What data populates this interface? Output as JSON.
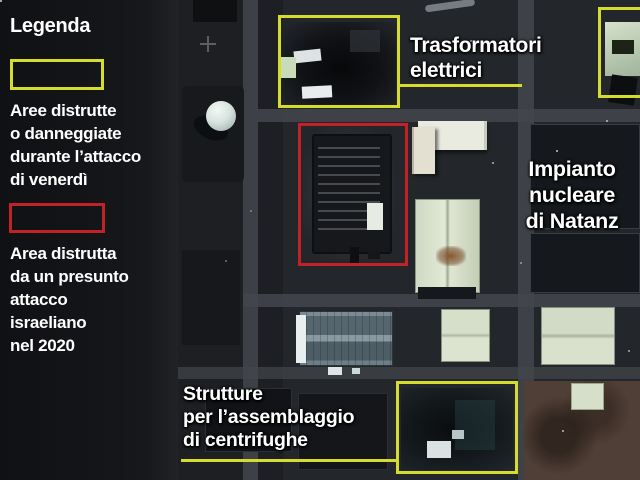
{
  "colors": {
    "highlight_yellow": "#d6dc2b",
    "highlight_red": "#c42127",
    "label_text": "#ffffff",
    "panel_background": "#141518"
  },
  "legend": {
    "title": "Legenda",
    "items": [
      {
        "id": "yellow-destroyed-friday",
        "label": "Aree distrutte\no danneggiate\ndurante l’attacco\ndi venerdì"
      },
      {
        "id": "red-destroyed-2020",
        "label": "Area distrutta\nda un presunto\nattacco\nisraeliano\nnel 2020"
      }
    ]
  },
  "map": {
    "facility_title": "Impianto nucleare\ndi Natanz",
    "annotations": {
      "transformers": "Trasformatori\nelettrici",
      "centrifuges": "Strutture\nper l’assemblaggio\ndi centrifughe"
    }
  }
}
